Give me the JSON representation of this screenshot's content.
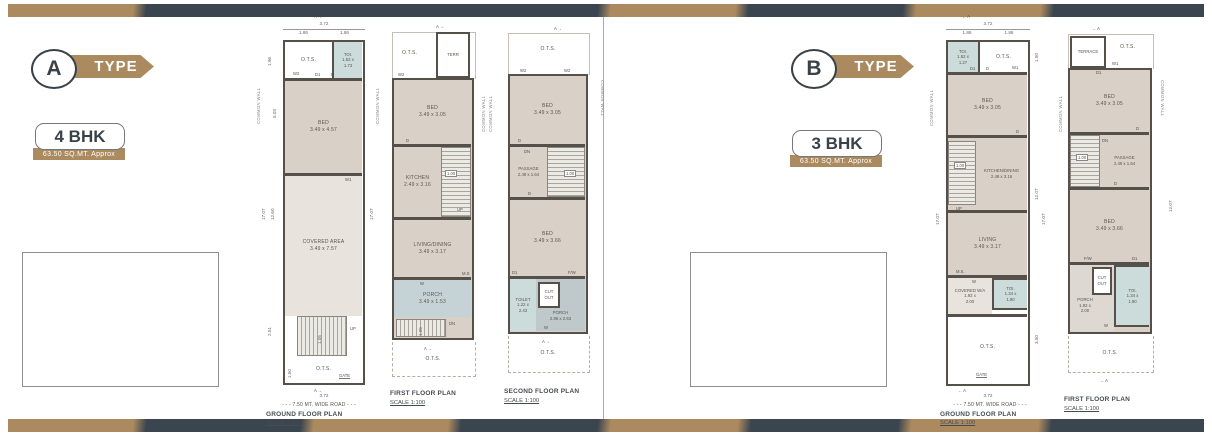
{
  "palette": {
    "tan": "#ab8a5f",
    "slate": "#3b4550",
    "wall": "#55504a",
    "room_beige": "#d9d1c8",
    "room_beige_light": "#e8e3dc",
    "room_blue": "#cbdcdb",
    "porch_blue": "#c6d3d6",
    "porch_gray": "#bfc9cc"
  },
  "section_a": {
    "badge": {
      "letter": "A",
      "word": "TYPE"
    },
    "card": {
      "title": "4 BHK",
      "subtitle": "63.50 SQ.MT. Approx"
    },
    "ground": {
      "section_marker": "A →",
      "section_marker_bottom": "A →",
      "dim_width": "3.72",
      "dim_half_l": "1.86",
      "dim_half_r": "1.86",
      "common_wall_left": "COMMON WALL",
      "common_wall_right": "COMMON WALL",
      "dims": {
        "d1": "1.96",
        "d2": "5.03",
        "d3": "17.07",
        "d4": "12.60",
        "d5": "2.51",
        "d6": "1.50",
        "right": "17.07",
        "stair": "1.05"
      },
      "ots_top": "O.T.S.",
      "toi": {
        "name": "TOI.",
        "dim1": "1.52 x",
        "dim2": "1.73"
      },
      "bed": {
        "name": "BED",
        "dim": "3.49 x 4.57"
      },
      "covered": {
        "name": "COVERED AREA",
        "dim": "3.49 x 7.57"
      },
      "ots_bottom": "O.T.S.",
      "markers": {
        "w2": "W2",
        "d1": "D1",
        "d": "D",
        "w1": "W1",
        "up": "UP",
        "gate": "GATE"
      },
      "dim_bottom": "3.72",
      "road": "- - - 7.50 MT. WIDE ROAD - - -",
      "title": "GROUND FLOOR PLAN",
      "scale": "SCALE 1:100"
    },
    "first": {
      "section_marker": "A →",
      "section_marker_bottom": "A →",
      "ots_top": "O.T.S.",
      "terrace": "TERR",
      "common_wall_1": "COMMON WALL",
      "common_wall_2": "COMMON WALL",
      "bed": {
        "name": "BED",
        "dim": "3.49 x 3.05"
      },
      "kitchen": {
        "name": "KITCHEN",
        "dim": "2.49 x 3.16"
      },
      "living": {
        "name": "LIVING/DINING",
        "dim": "3.49 x 3.17"
      },
      "porch": {
        "name": "PORCH",
        "dim": "3.49 x 1.53"
      },
      "ots_bottom": "O.T.S.",
      "dims": {
        "stair": "1.00",
        "stair_dn": "1.05"
      },
      "markers": {
        "w2": "W2",
        "d": "D",
        "up": "UP",
        "dn": "DN",
        "ms": "M.S",
        "w": "W"
      },
      "title": "FIRST FLOOR PLAN",
      "scale": "SCALE 1:100"
    },
    "second": {
      "section_marker": "A →",
      "section_marker_bottom": "A →",
      "ots_top": "O.T.S.",
      "common_wall": "COMMON WALL",
      "bed1": {
        "name": "BED",
        "dim": "3.49 x 3.05"
      },
      "passage": {
        "name": "PASSAGE",
        "dim": "2.49 x 1.64"
      },
      "bed2": {
        "name": "BED",
        "dim": "3.49 x 3.66"
      },
      "toilet": {
        "name": "TOILET",
        "dim1": "1.22 x",
        "dim2": "2.43"
      },
      "cutout": {
        "line1": "CUT",
        "line2": "OUT"
      },
      "porch": {
        "name": "PORCH",
        "dim": "2.86 x 2.53"
      },
      "ots_bottom": "O.T.S.",
      "dims": {
        "stair": "1.00"
      },
      "markers": {
        "w2a": "W2",
        "w2b": "W2",
        "d_top": "D",
        "dn": "DN",
        "d_mid": "D",
        "d1": "D1",
        "fw": "F/W",
        "w": "W"
      },
      "title": "SECOND FLOOR PLAN",
      "scale": "SCALE 1:100"
    }
  },
  "section_b": {
    "badge": {
      "letter": "B",
      "word": "TYPE"
    },
    "card": {
      "title": "3 BHK",
      "subtitle": "63.50 SQ.MT. Approx"
    },
    "ground": {
      "section_marker": "← A",
      "section_marker_bottom": "← A",
      "dim_width": "3.72",
      "dim_half_l": "1.86",
      "dim_half_r": "1.86",
      "common_wall": "COMMON WALL",
      "dims": {
        "right1": "1.50",
        "right2": "12.07",
        "right3": "17.07",
        "right4": "3.50",
        "left": "17.07",
        "stair": "1.00"
      },
      "toi_top": {
        "name": "TOI.",
        "dim1": "1.52 x",
        "dim2": "1.27"
      },
      "ots_top": "O.T.S.",
      "bed": {
        "name": "BED",
        "dim": "3.49 x 3.05"
      },
      "kitchen": {
        "name": "KITCHEN/DINING",
        "dim": "2.49 x 3.16"
      },
      "living": {
        "name": "LIVING",
        "dim": "3.49 x 3.17"
      },
      "covered": {
        "name": "COVERED W/A",
        "dim1": "1.92 x",
        "dim2": "2.00"
      },
      "toi_bottom": {
        "name": "TOI.",
        "dim1": "1.34 x",
        "dim2": "1.90"
      },
      "ots_bottom": "O.T.S.",
      "markers": {
        "w1": "W1",
        "d1": "D1",
        "d_top": "D",
        "d_bed": "D",
        "up": "UP",
        "ms": "M.S.",
        "w": "W",
        "gate": "GATE"
      },
      "dim_bottom": "3.72",
      "road": "- - - 7.50 MT. WIDE ROAD - - -",
      "title": "GROUND FLOOR PLAN",
      "scale": "SCALE 1:100"
    },
    "first": {
      "section_marker": "← A",
      "section_marker_bottom": "← A",
      "terrace": "TERRACE",
      "ots_top": "O.T.S.",
      "common_wall_left": "COMMON WALL",
      "common_wall_right": "COMMON WALL",
      "dims": {
        "stair": "1.00",
        "right": "12.07"
      },
      "bed1": {
        "name": "BED",
        "dim": "3.49 x 3.05"
      },
      "passage": {
        "name": "PASSAGE",
        "dim": "2.49 x 1.64"
      },
      "bed2": {
        "name": "BED",
        "dim": "3.49 x 3.66"
      },
      "porch": {
        "name": "PORCH",
        "dim1": "1.92 x",
        "dim2": "2.00"
      },
      "cutout": {
        "line1": "CUT",
        "line2": "OUT"
      },
      "toi": {
        "name": "TOI.",
        "dim1": "1.34 x",
        "dim2": "1.90"
      },
      "ots_bottom": "O.T.S.",
      "markers": {
        "w1": "W1",
        "d1_top": "D1",
        "d_bed": "D",
        "dn": "DN",
        "d_mid": "D",
        "d1_low": "D1",
        "fw": "F/W",
        "w": "W"
      },
      "title": "FIRST FLOOR PLAN",
      "scale": "SCALE 1:100"
    }
  }
}
